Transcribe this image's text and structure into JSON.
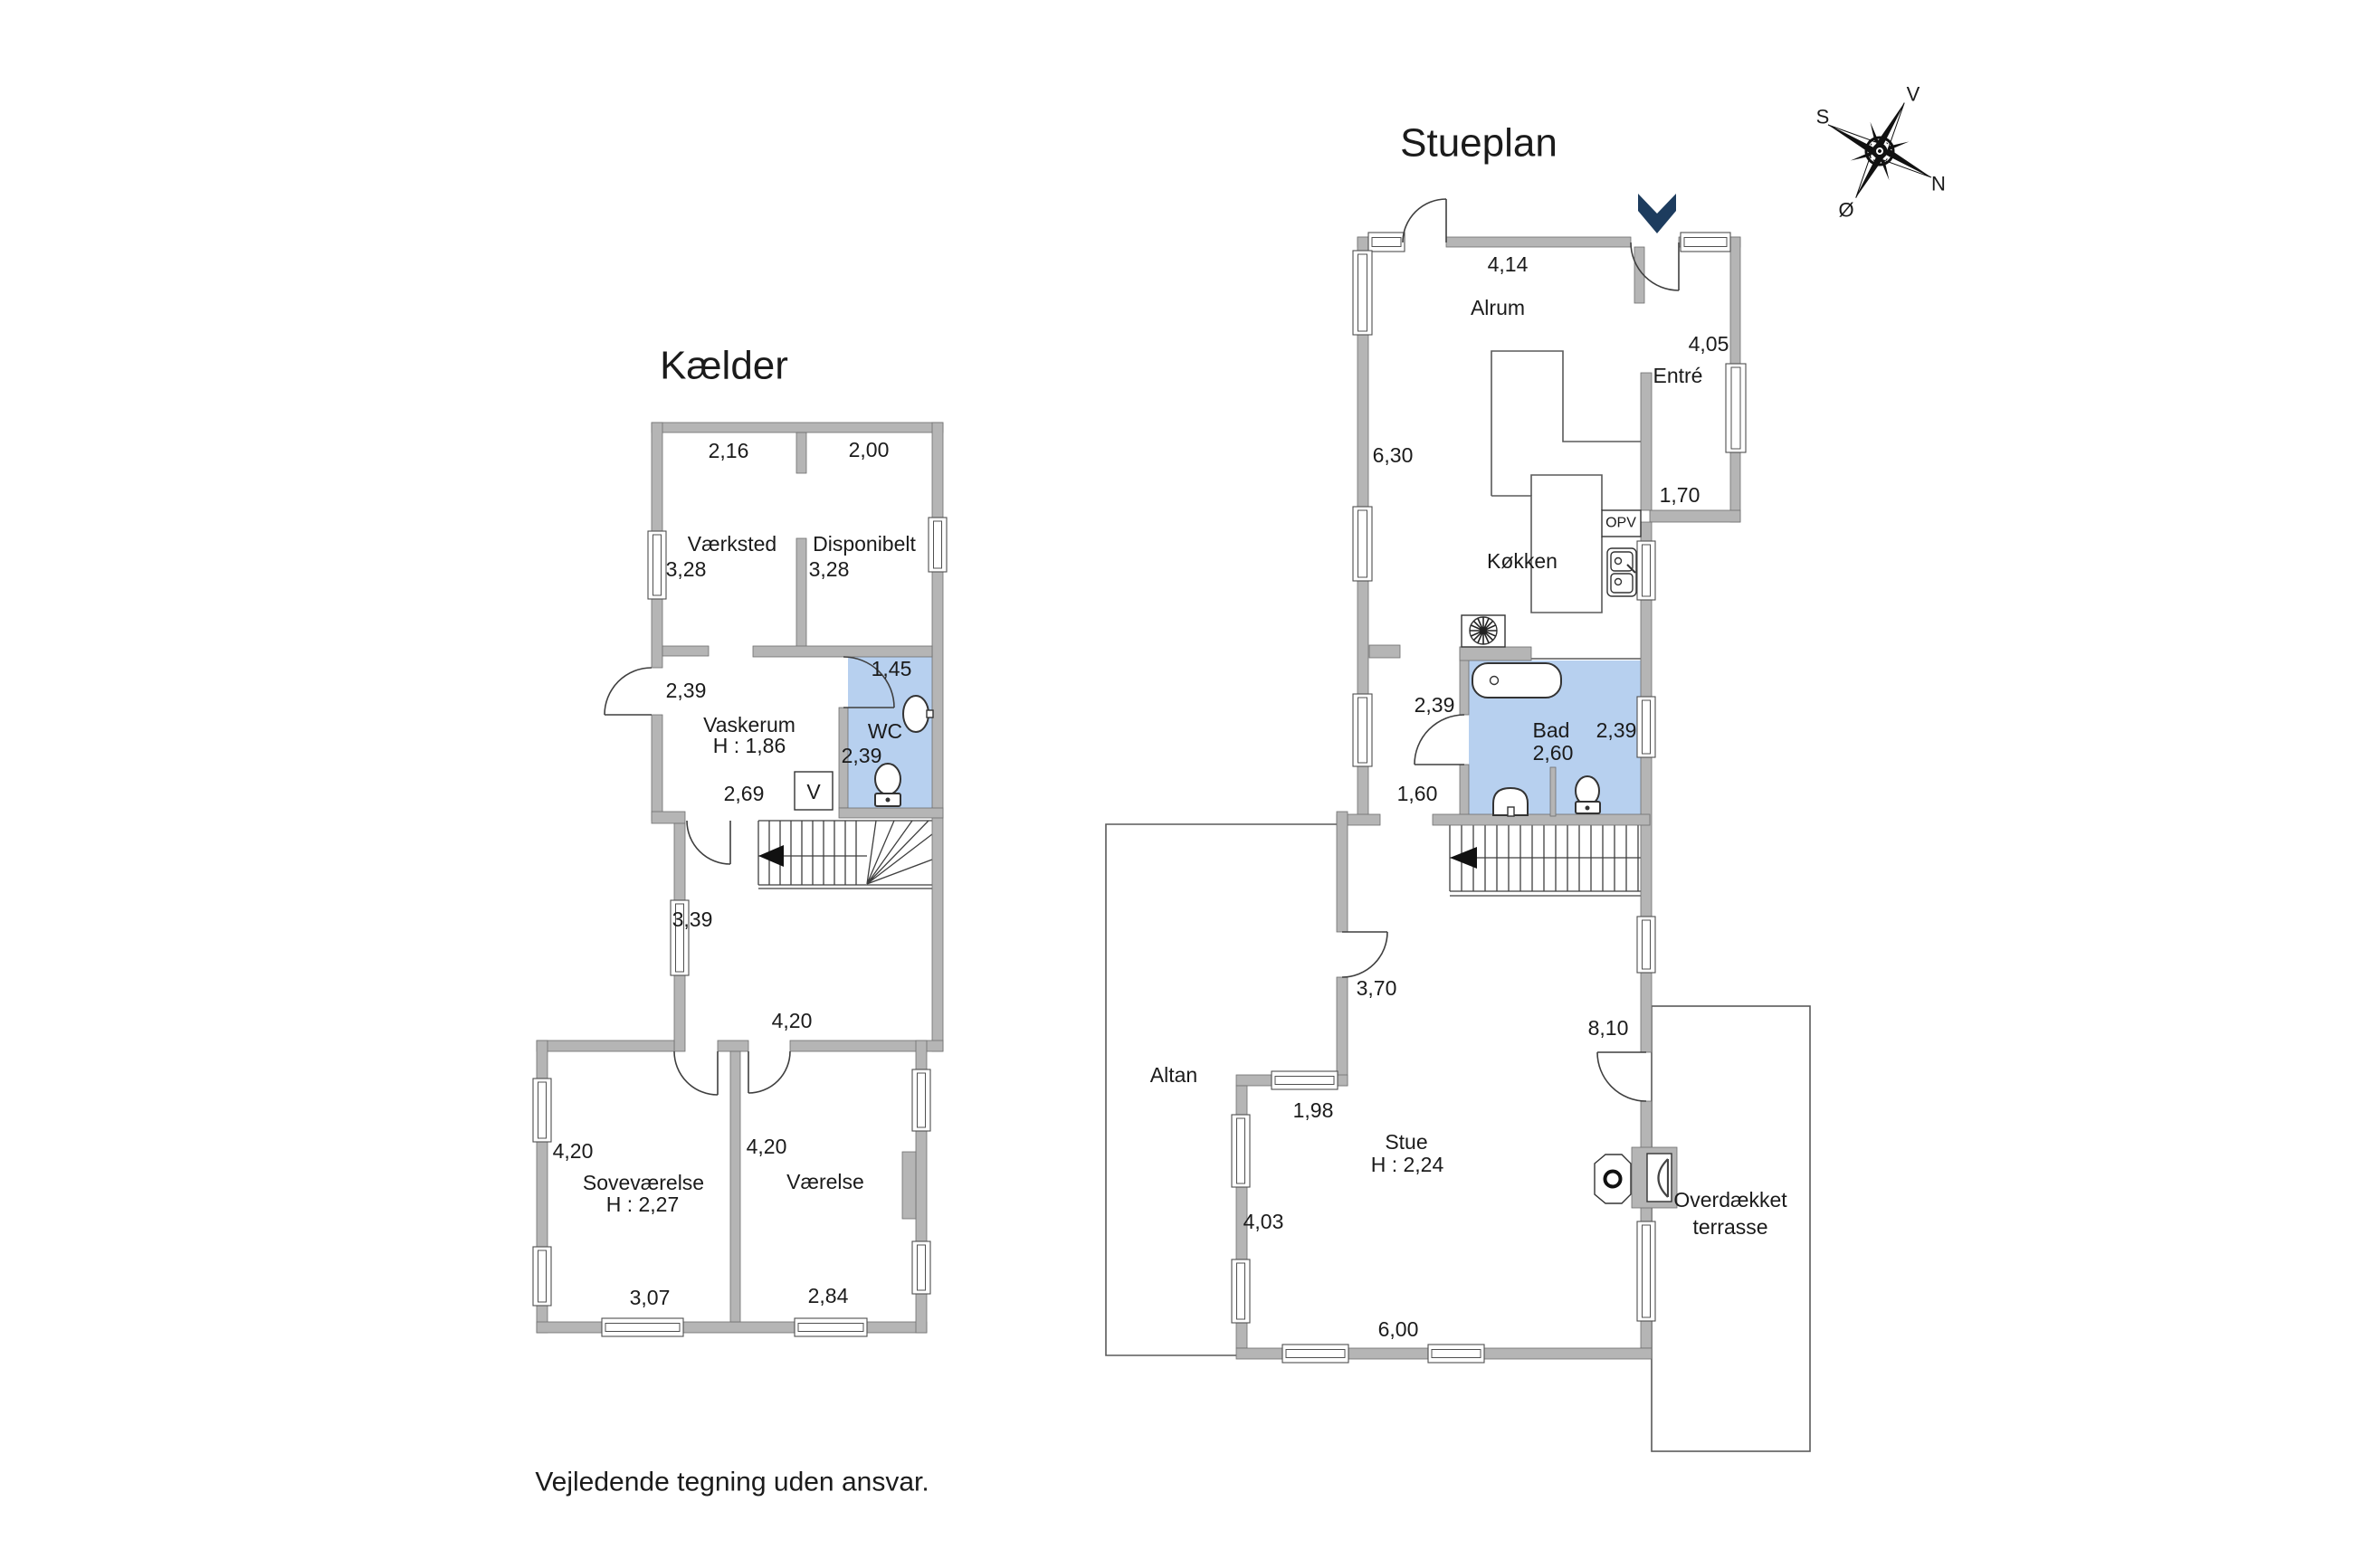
{
  "colors": {
    "wall": "#b5b5b5",
    "wall-edge": "#6f6f6f",
    "room-blue": "#b7d0ef",
    "arrow-navy": "#1d3c5e",
    "line-dark": "#4a4a4a",
    "text": "#1b1b1b"
  },
  "footer": {
    "disclaimer": "Vejledende tegning uden ansvar."
  },
  "compass": {
    "south": "S",
    "west": "V",
    "north": "N",
    "east": "Ø"
  },
  "kaelder": {
    "title": "Kælder",
    "rooms": {
      "vaerksted": "Værksted",
      "disponibelt": "Disponibelt",
      "vaskerum": "Vaskerum",
      "vaskerum_height": "H : 1,86",
      "wc": "WC",
      "v_box": "V",
      "sovevaerelse": "Soveværelse",
      "sovevaerelse_height": "H : 2,27",
      "vaerelse": "Værelse"
    },
    "dims": {
      "top_left": "2,16",
      "top_right": "2,00",
      "vaerksted_side": "3,28",
      "disponibelt_side": "3,28",
      "vaskerum_left": "2,39",
      "wc_top": "1,45",
      "wc_side": "2,39",
      "vaskerum_bottom": "2,69",
      "hall_side": "3,39",
      "lower_top": "4,20",
      "sovevaerelse_side": "4,20",
      "vaerelse_side": "4,20",
      "sovevaerelse_bottom": "3,07",
      "vaerelse_bottom": "2,84"
    }
  },
  "stueplan": {
    "title": "Stueplan",
    "rooms": {
      "alrum": "Alrum",
      "entre": "Entré",
      "koekken": "Køkken",
      "opv": "OPV",
      "bad": "Bad",
      "stue": "Stue",
      "stue_height": "H : 2,24",
      "altan": "Altan",
      "terrasse_line1": "Overdækket",
      "terrasse_line2": "terrasse"
    },
    "dims": {
      "alrum_top": "4,14",
      "entre_side": "4,05",
      "alrum_side": "6,30",
      "entre_bottom": "1,70",
      "bad_left": "2,39",
      "bad_right": "2,39",
      "bad_width": "2,60",
      "hall_bottom": "1,60",
      "stue_door": "3,70",
      "stue_side": "8,10",
      "altan_step": "1,98",
      "stue_left": "4,03",
      "stue_bottom": "6,00"
    }
  }
}
